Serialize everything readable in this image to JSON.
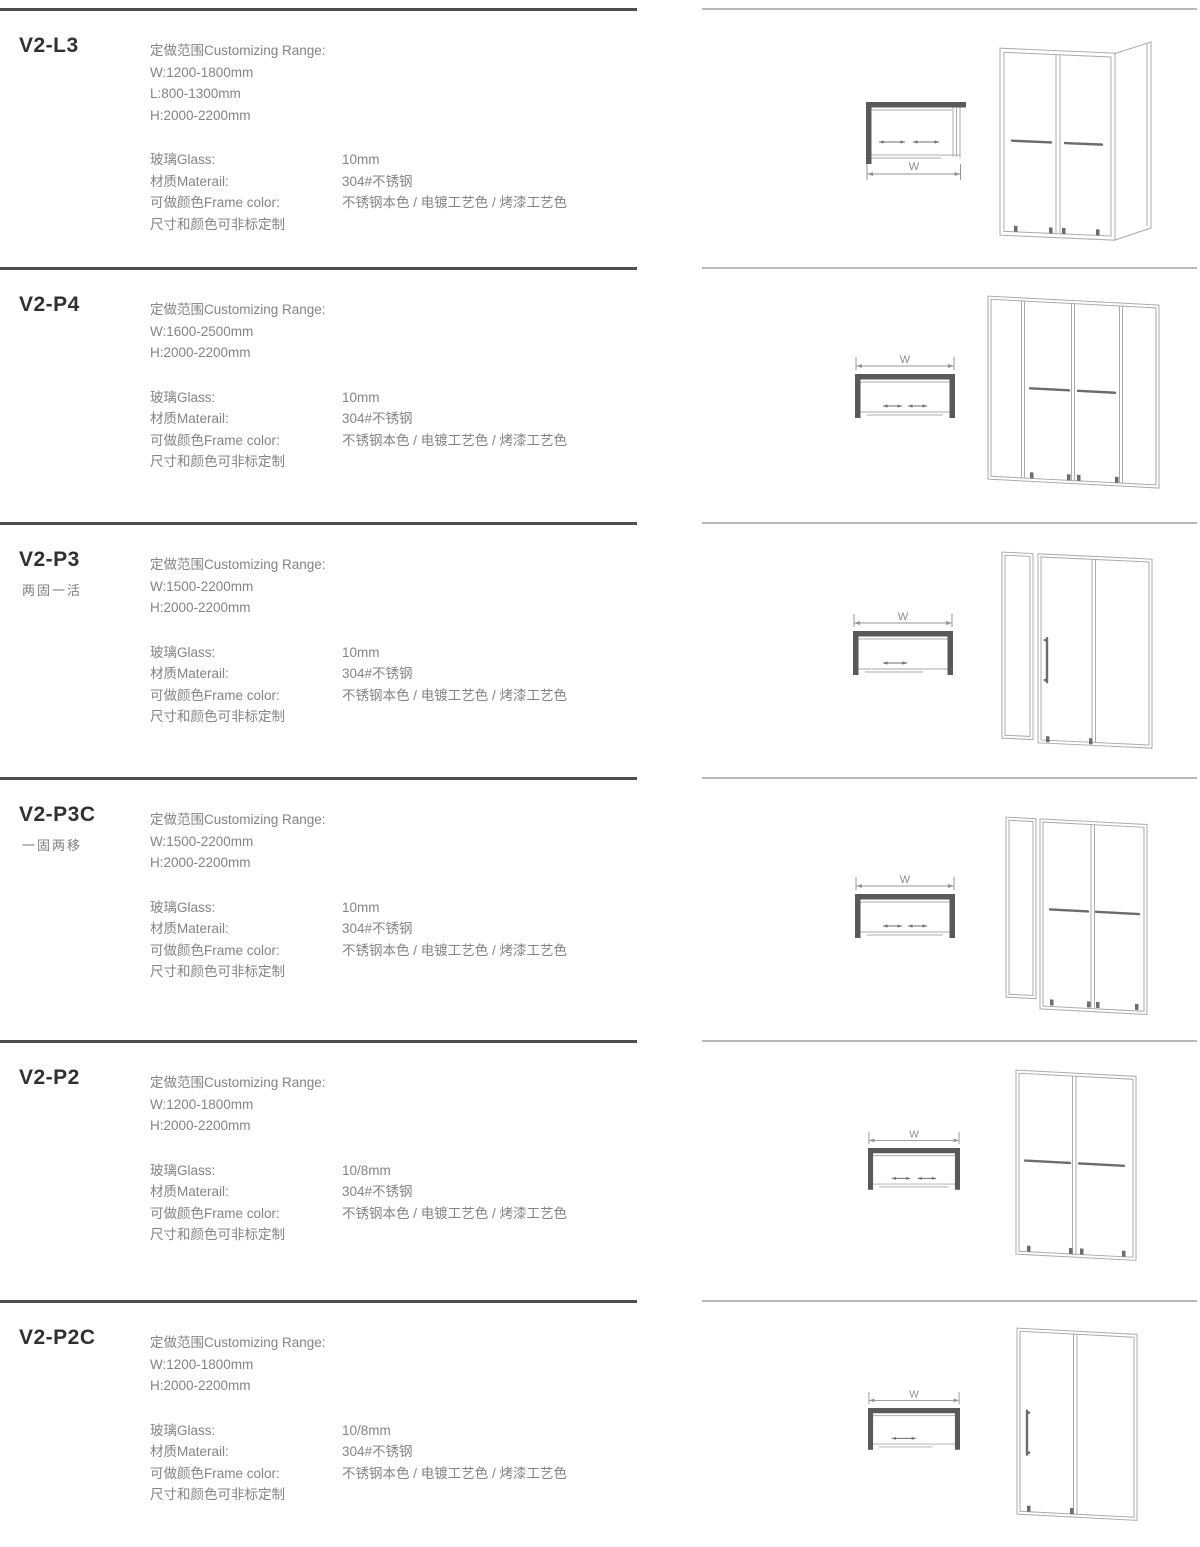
{
  "labels": {
    "range_title": "定做范围Customizing Range:",
    "glass": "玻璃Glass:",
    "material": "材质Materail:",
    "frame_color": "可做颜色Frame color:",
    "custom_note": "尺寸和颜色可非标定制"
  },
  "sections": [
    {
      "model": "V2-L3",
      "range_lines": [
        "W:1200-1800mm",
        "L:800-1300mm",
        "H:2000-2200mm"
      ],
      "glass": "10mm",
      "material": "304#不锈钢",
      "frame_color": "不锈钢本色 / 电镀工艺色 / 烤漆工艺色",
      "dim_label": "W"
    },
    {
      "model": "V2-P4",
      "range_lines": [
        "W:1600-2500mm",
        "H:2000-2200mm"
      ],
      "glass": "10mm",
      "material": "304#不锈钢",
      "frame_color": "不锈钢本色 / 电镀工艺色 / 烤漆工艺色",
      "dim_label": "W"
    },
    {
      "model": "V2-P3",
      "subtitle": "两固一活",
      "range_lines": [
        "W:1500-2200mm",
        "H:2000-2200mm"
      ],
      "glass": "10mm",
      "material": "304#不锈钢",
      "frame_color": "不锈钢本色 / 电镀工艺色 / 烤漆工艺色",
      "dim_label": "W"
    },
    {
      "model": "V2-P3C",
      "subtitle": "一固两移",
      "range_lines": [
        "W:1500-2200mm",
        "H:2000-2200mm"
      ],
      "glass": "10mm",
      "material": "304#不锈钢",
      "frame_color": "不锈钢本色 / 电镀工艺色 / 烤漆工艺色",
      "dim_label": "W"
    },
    {
      "model": "V2-P2",
      "range_lines": [
        "W:1200-1800mm",
        "H:2000-2200mm"
      ],
      "glass": "10/8mm",
      "material": "304#不锈钢",
      "frame_color": "不锈钢本色 / 电镀工艺色 / 烤漆工艺色",
      "dim_label": "W"
    },
    {
      "model": "V2-P2C",
      "range_lines": [
        "W:1200-1800mm",
        "H:2000-2200mm"
      ],
      "glass": "10/8mm",
      "material": "304#不锈钢",
      "frame_color": "不锈钢本色 / 电镀工艺色 / 烤漆工艺色",
      "dim_label": "W"
    }
  ],
  "colors": {
    "divider_dark": "#4d4e50",
    "divider_light": "#b8b9bb",
    "model_text": "#303032",
    "body_text": "#828487",
    "plan_bar": "#58595b",
    "drawing_line": "#a9abae",
    "drawing_dark": "#6b6c6f"
  }
}
